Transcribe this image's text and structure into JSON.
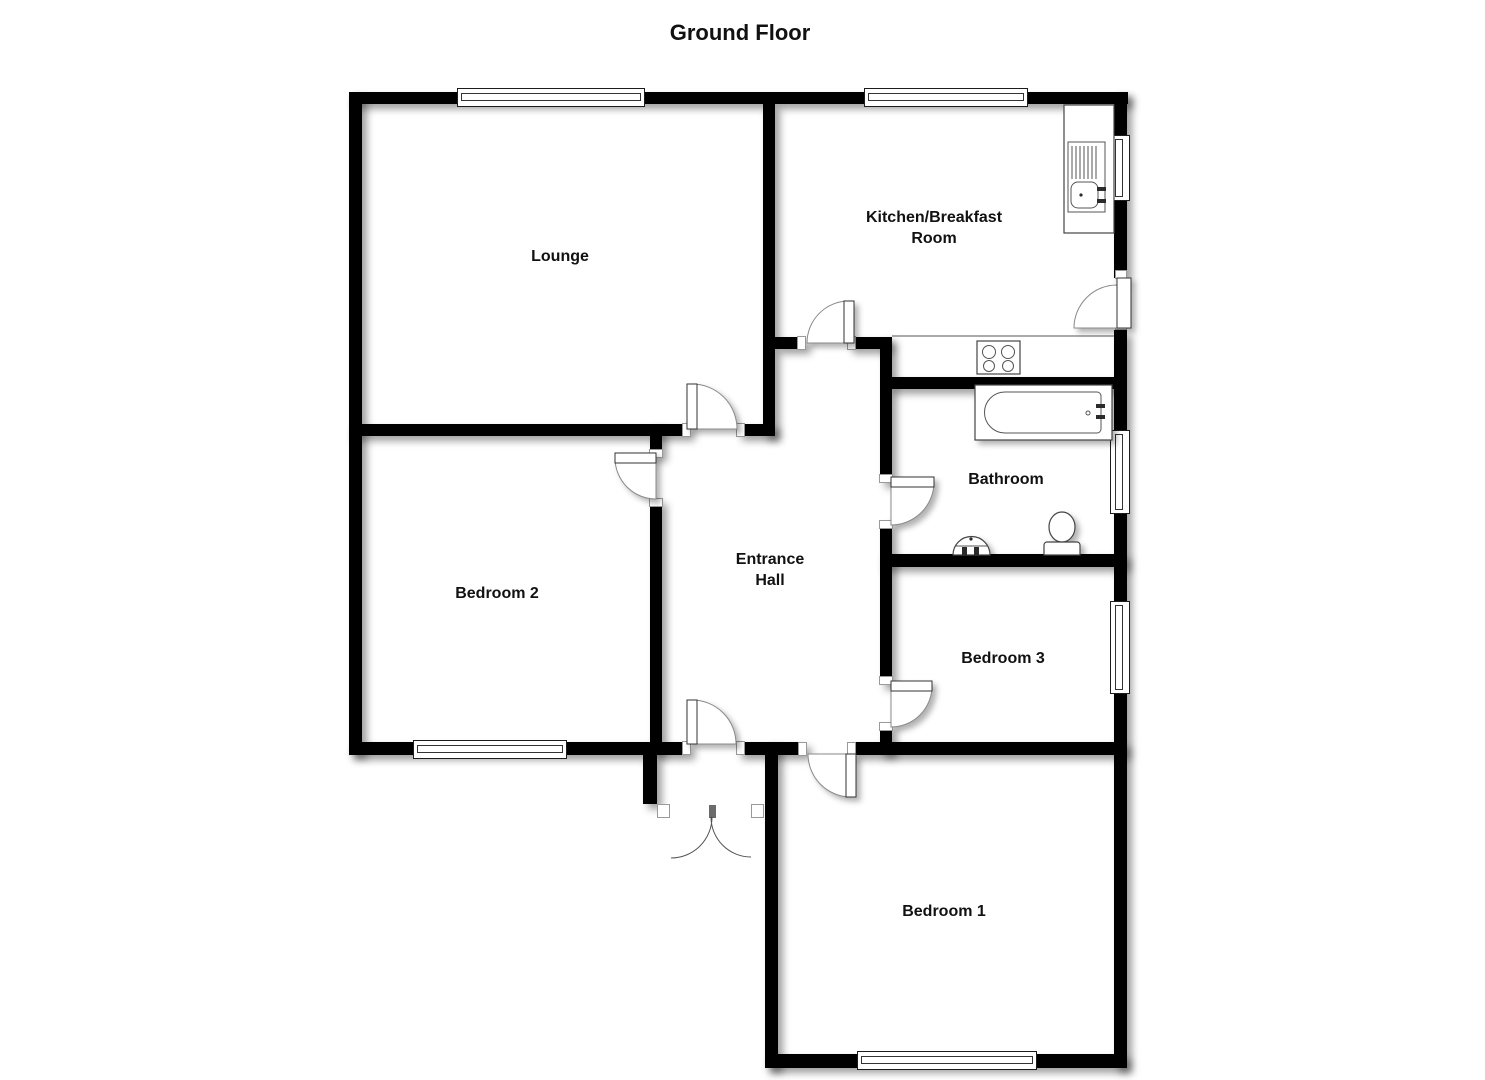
{
  "title": "Ground Floor",
  "rooms": {
    "lounge": {
      "label": "Lounge"
    },
    "kitchen": {
      "label_line1": "Kitchen/Breakfast",
      "label_line2": "Room"
    },
    "entrance_hall": {
      "label_line1": "Entrance",
      "label_line2": "Hall"
    },
    "bedroom2": {
      "label": "Bedroom 2"
    },
    "bathroom": {
      "label": "Bathroom"
    },
    "bedroom3": {
      "label": "Bedroom 3"
    },
    "bedroom1": {
      "label": "Bedroom 1"
    }
  },
  "fixtures": {
    "kitchen": [
      "sink-with-drainer",
      "worktop-counter",
      "hob-4-ring"
    ],
    "bathroom": [
      "bath-tub",
      "wash-basin",
      "toilet"
    ]
  },
  "openings": {
    "window_count": 7,
    "internal_door_count": 7,
    "external_doors": [
      "kitchen-back-door",
      "front-double-door"
    ]
  },
  "colors": {
    "wall": "#000000",
    "background": "#ffffff",
    "text": "#111111",
    "fixture_outline": "#444444"
  }
}
